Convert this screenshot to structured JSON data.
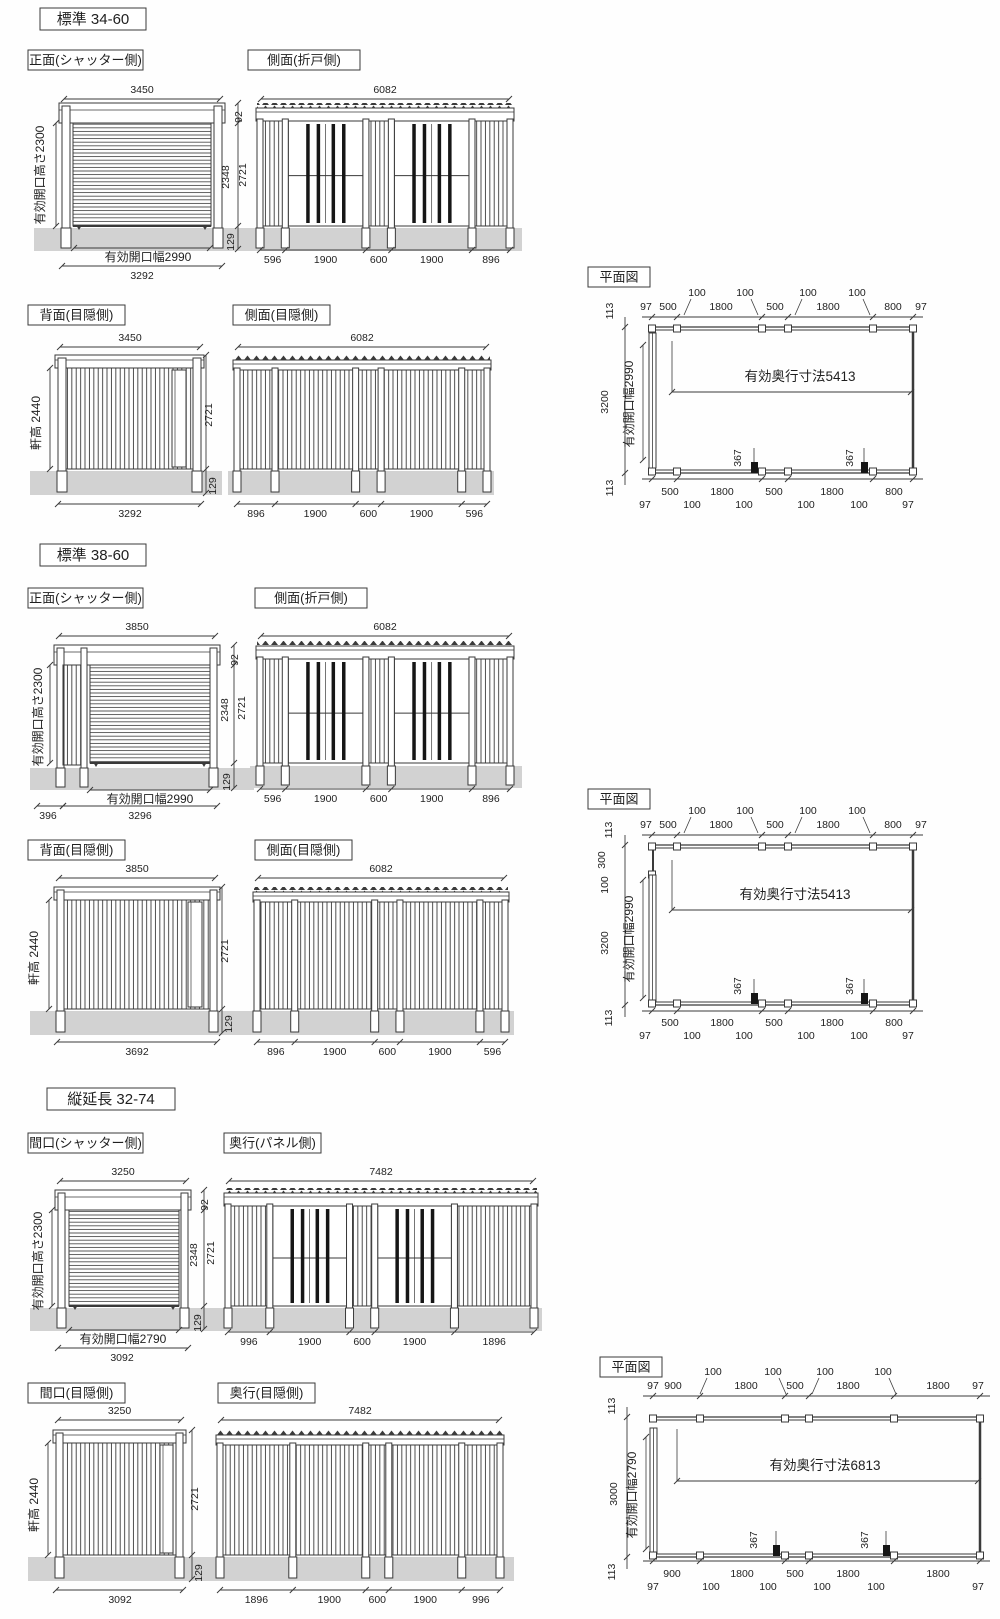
{
  "document": {
    "background": "#ffffff",
    "line_color": "#3a3a3a",
    "ground_color": "#d2d2d2",
    "bar_color": "#161616"
  },
  "sections": [
    {
      "badge": "標準 34-60",
      "views": [
        {
          "title": "正面(シャッター側)",
          "type": "shutter-front",
          "top": "3450",
          "left": "有効開口高さ2300",
          "right": [
            "92",
            "2348",
            "2721",
            "129"
          ],
          "bottom": [
            "有効開口幅2990",
            "3292"
          ]
        },
        {
          "title": "側面(折戸側)",
          "type": "door-side",
          "top": "6082",
          "bottom": [
            "596",
            "1900",
            "600",
            "1900",
            "896"
          ]
        },
        {
          "title": "背面(目隠側)",
          "type": "privacy-back",
          "top": "3450",
          "left": "軒高 2440",
          "right": [
            "2721",
            "129"
          ],
          "bottom": [
            "3292"
          ]
        },
        {
          "title": "側面(目隠側)",
          "type": "privacy-side",
          "top": "6082",
          "bottom": [
            "896",
            "1900",
            "600",
            "1900",
            "596"
          ]
        }
      ],
      "plan": {
        "title": "平面図",
        "top_row1": [
          "100",
          "100",
          "100",
          "100"
        ],
        "top_row2": [
          "97",
          "500",
          "1800",
          "500",
          "1800",
          "800",
          "97"
        ],
        "left": [
          "113",
          "3200",
          "113"
        ],
        "opening_label": "有効開口幅2990",
        "depth_label": "有効奥行寸法5413",
        "marks": [
          "367",
          "367"
        ],
        "bottom_row1": [
          "500",
          "1800",
          "500",
          "1800",
          "800"
        ],
        "bottom_row2": [
          "97",
          "100",
          "100",
          "100",
          "100",
          "97"
        ]
      }
    },
    {
      "badge": "標準 38-60",
      "views": [
        {
          "title": "正面(シャッター側)",
          "type": "shutter-front-ext",
          "top": "3850",
          "left": "有効開口高さ2300",
          "right": [
            "92",
            "2348",
            "2721",
            "129"
          ],
          "bottom": [
            "有効開口幅2990",
            "396",
            "3296"
          ]
        },
        {
          "title": "側面(折戸側)",
          "type": "door-side",
          "top": "6082",
          "bottom": [
            "596",
            "1900",
            "600",
            "1900",
            "896"
          ]
        },
        {
          "title": "背面(目隠側)",
          "type": "privacy-back",
          "top": "3850",
          "left": "軒高 2440",
          "right": [
            "2721",
            "129"
          ],
          "bottom": [
            "3692"
          ]
        },
        {
          "title": "側面(目隠側)",
          "type": "privacy-side",
          "top": "6082",
          "bottom": [
            "896",
            "1900",
            "600",
            "1900",
            "596"
          ]
        }
      ],
      "plan": {
        "title": "平面図",
        "top_row1": [
          "100",
          "100",
          "100",
          "100"
        ],
        "top_row2": [
          "97",
          "500",
          "1800",
          "500",
          "1800",
          "800",
          "97"
        ],
        "left": [
          "113",
          "300",
          "100",
          "3200",
          "113"
        ],
        "opening_label": "有効開口幅2990",
        "depth_label": "有効奥行寸法5413",
        "marks": [
          "367",
          "367"
        ],
        "bottom_row1": [
          "500",
          "1800",
          "500",
          "1800",
          "800"
        ],
        "bottom_row2": [
          "97",
          "100",
          "100",
          "100",
          "100",
          "97"
        ]
      }
    },
    {
      "badge": "縦延長 32-74",
      "views": [
        {
          "title": "間口(シャッター側)",
          "type": "shutter-front",
          "top": "3250",
          "left": "有効開口高さ2300",
          "right": [
            "92",
            "2348",
            "2721",
            "129"
          ],
          "bottom": [
            "有効開口幅2790",
            "3092"
          ]
        },
        {
          "title": "奥行(パネル側)",
          "type": "door-side",
          "top": "7482",
          "bottom": [
            "996",
            "1900",
            "600",
            "1900",
            "1896"
          ]
        },
        {
          "title": "間口(目隠側)",
          "type": "privacy-back",
          "top": "3250",
          "left": "軒高 2440",
          "right": [
            "2721",
            "129"
          ],
          "bottom": [
            "3092"
          ]
        },
        {
          "title": "奥行(目隠側)",
          "type": "privacy-side",
          "top": "7482",
          "bottom": [
            "1896",
            "1900",
            "600",
            "1900",
            "996"
          ]
        }
      ],
      "plan": {
        "title": "平面図",
        "top_row1": [
          "100",
          "100",
          "100",
          "100"
        ],
        "top_row2": [
          "97",
          "900",
          "1800",
          "500",
          "1800",
          "1800",
          "97"
        ],
        "left": [
          "113",
          "3000",
          "113"
        ],
        "opening_label": "有効開口幅2790",
        "depth_label": "有効奥行寸法6813",
        "marks": [
          "367",
          "367"
        ],
        "bottom_row1": [
          "900",
          "1800",
          "500",
          "1800",
          "1800"
        ],
        "bottom_row2": [
          "97",
          "100",
          "100",
          "100",
          "100",
          "97"
        ]
      }
    }
  ]
}
